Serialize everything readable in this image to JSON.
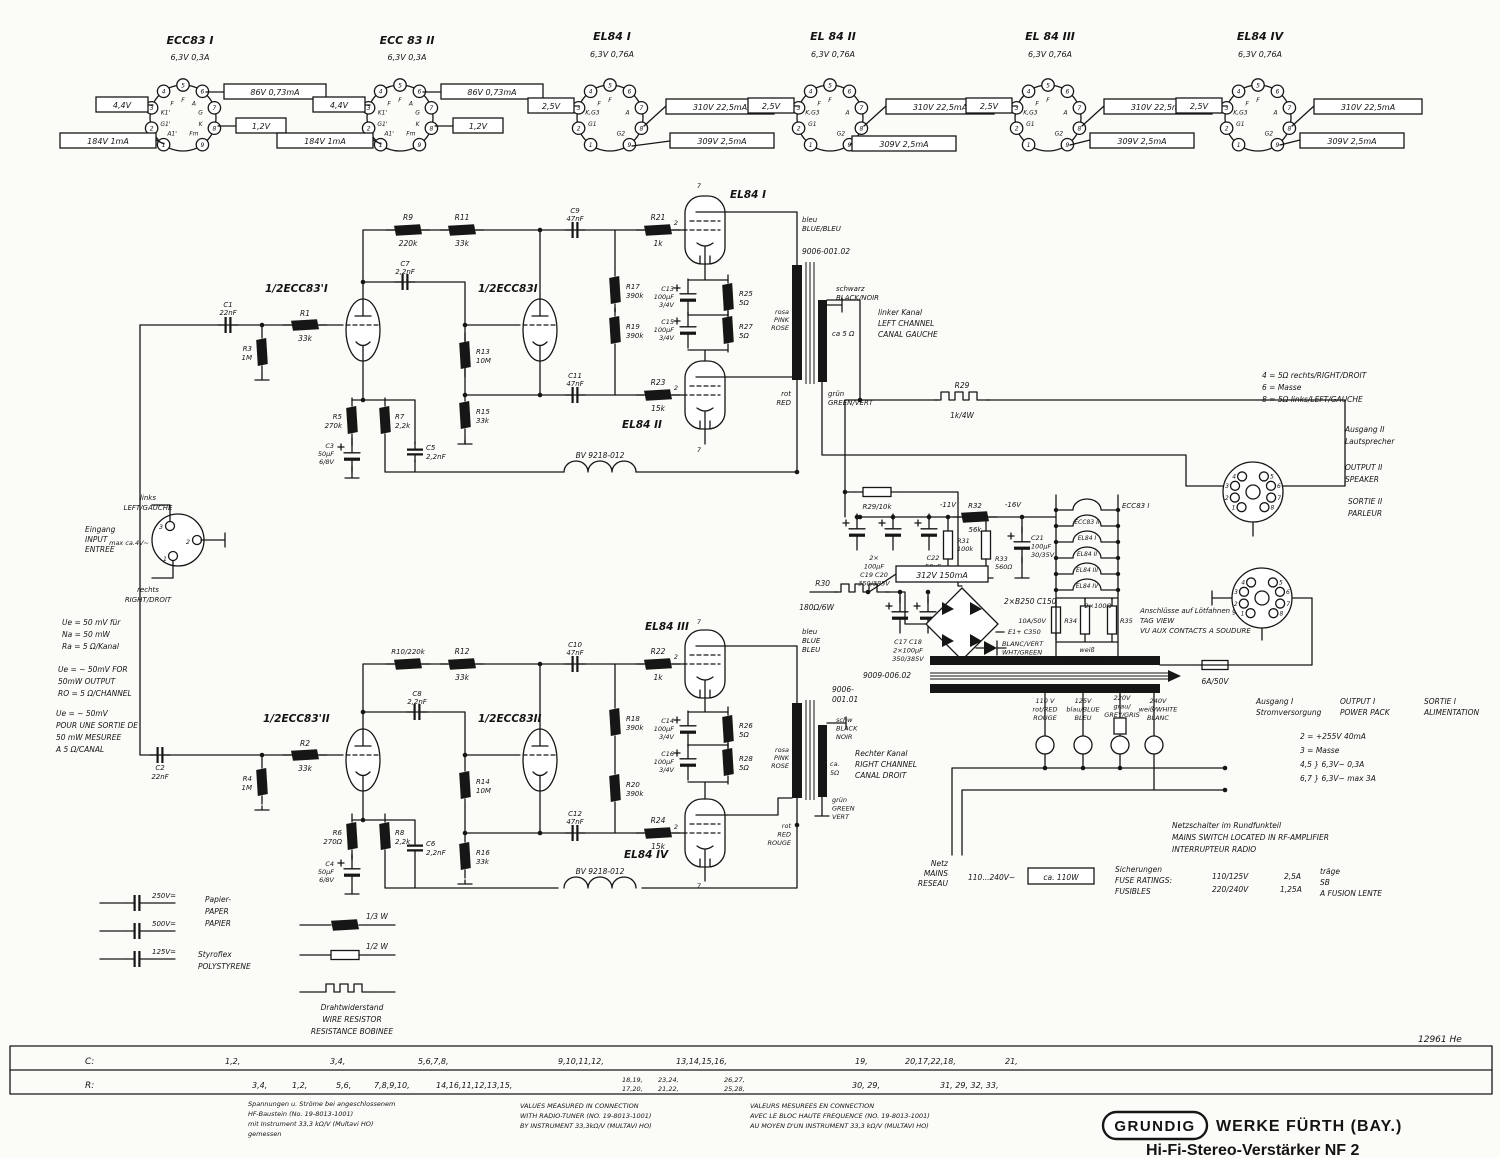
{
  "doc": {
    "number": "12961 He"
  },
  "logo": {
    "brand": "GRUNDIG",
    "firm": "WERKE FÜRTH (BAY.)",
    "model": "Hi-Fi-Stereo-Verstärker NF 2"
  },
  "digits": [
    "0",
    "1",
    "2",
    "3",
    "4",
    "5",
    "6",
    "7",
    "8",
    "9"
  ],
  "tube_sockets": [
    {
      "title": "ECC83 I",
      "heater": "6,3V 0,3A",
      "left": "4,4V",
      "bottom": "184V 1mA",
      "right_top": "86V 0,73mA",
      "right_bottom": "1,2V",
      "pins": {
        "1": "A1'",
        "2": "G1'",
        "3": "K1'",
        "4": "F",
        "5": "F",
        "6": "A",
        "7": "G",
        "8": "K",
        "9": "Fm"
      }
    },
    {
      "title": "ECC 83 II",
      "heater": "6,3V 0,3A",
      "left": "4,4V",
      "bottom": "184V 1mA",
      "right_top": "86V 0,73mA",
      "right_bottom": "1,2V",
      "pins": {
        "1": "A1'",
        "2": "G1'",
        "3": "K1'",
        "4": "F",
        "5": "F",
        "6": "A",
        "7": "G",
        "8": "K",
        "9": "Fm"
      }
    },
    {
      "title": "EL84 I",
      "heater": "6,3V 0,76A",
      "left": "2,5V",
      "right_top": "310V 22,5mA",
      "right_bottom": "309V 2,5mA",
      "pins": {
        "2": "G1",
        "3": "K,G3",
        "4": "F",
        "5": "F",
        "7": "A",
        "9": "G2"
      }
    },
    {
      "title": "EL 84 II",
      "heater": "6,3V 0,76A",
      "left": "2,5V",
      "right_top": "310V 22,5mA",
      "right_bottom": "309V 2,5mA",
      "pins": {
        "2": "G1",
        "3": "K,G3",
        "4": "F",
        "5": "F",
        "7": "A",
        "9": "G2"
      }
    },
    {
      "title": "EL 84 III",
      "heater": "6,3V 0,76A",
      "left": "2,5V",
      "right_top": "310V 22,5mA",
      "right_bottom": "309V 2,5mA",
      "pins": {
        "2": "G1",
        "3": "K,G3",
        "4": "F",
        "5": "F",
        "7": "A",
        "9": "G2"
      }
    },
    {
      "title": "EL84 IV",
      "heater": "6,3V 0,76A",
      "left": "2,5V",
      "right_top": "310V 22,5mA",
      "right_bottom": "309V 2,5mA",
      "pins": {
        "2": "G1",
        "3": "K,G3",
        "4": "F",
        "5": "F",
        "7": "A",
        "9": "G2"
      }
    }
  ],
  "upper": {
    "t1": "1/2ECC83'I",
    "t2": "1/2ECC83I",
    "el1": "EL84 I",
    "el2": "EL84 II",
    "c1": [
      "C1",
      "22nF"
    ],
    "r1": [
      "R1",
      "33k"
    ],
    "r3": [
      "R3",
      "1M"
    ],
    "r5": [
      "R5",
      "270k"
    ],
    "c3": [
      "C3",
      "50µF",
      "6/8V"
    ],
    "r7": [
      "R7",
      "2,2k"
    ],
    "c5": [
      "C5",
      "2,2nF"
    ],
    "c7": [
      "C7",
      "2,2nF"
    ],
    "r9": [
      "R9",
      "220k"
    ],
    "r11": [
      "R11",
      "33k"
    ],
    "r13": [
      "R13",
      "10M"
    ],
    "r15": [
      "R15",
      "33k"
    ],
    "c9": [
      "C9",
      "47nF"
    ],
    "c11": [
      "C11",
      "47nF"
    ],
    "r17": [
      "R17",
      "390k"
    ],
    "r19": [
      "R19",
      "390k"
    ],
    "r21": [
      "R21",
      "1k"
    ],
    "r23": [
      "R23",
      "15k"
    ],
    "c13": [
      "C13",
      "100µF",
      "3/4V"
    ],
    "c15": [
      "C15",
      "100µF",
      "3/4V"
    ],
    "r25": [
      "R25",
      "5Ω"
    ],
    "r27": [
      "R27",
      "5Ω"
    ],
    "bv": "BV 9218-012",
    "r29": [
      "R29",
      "1k/4W"
    ],
    "tr": {
      "part": "9006-001.02",
      "blue": [
        "bleu",
        "BLUE/BLEU"
      ],
      "black": [
        "schwarz",
        "BLACK/NOIR"
      ],
      "pink": [
        "rosa",
        "PINK",
        "ROSE"
      ],
      "red": [
        "rot",
        "RED"
      ],
      "green": [
        "grün",
        "GREEN/VERT"
      ],
      "imp": "ca 5 Ω",
      "channel": [
        "linker Kanal",
        "LEFT CHANNEL",
        "CANAL GAUCHE"
      ]
    }
  },
  "lower": {
    "t3": "1/2ECC83'II",
    "t4": "1/2ECC83II",
    "el3": "EL84 III",
    "el4": "EL84 IV",
    "c2": [
      "C2",
      "22nF"
    ],
    "r2": [
      "R2",
      "33k"
    ],
    "r4": [
      "R4",
      "1M"
    ],
    "r6": [
      "R6",
      "270Ω"
    ],
    "c4": [
      "C4",
      "50µF",
      "6/8V"
    ],
    "r8": [
      "R8",
      "2,2k"
    ],
    "c6": [
      "C6",
      "2,2nF"
    ],
    "c8": [
      "C8",
      "2,2nF"
    ],
    "r10": "R10/220k",
    "r12": [
      "R12",
      "33k"
    ],
    "r14": [
      "R14",
      "10M"
    ],
    "r16": [
      "R16",
      "33k"
    ],
    "c10": [
      "C10",
      "47nF"
    ],
    "c12": [
      "C12",
      "47nF"
    ],
    "r18": [
      "R18",
      "390k"
    ],
    "r20": [
      "R20",
      "390k"
    ],
    "r22": [
      "R22",
      "1k"
    ],
    "r24": [
      "R24",
      "15k"
    ],
    "c14": [
      "C14",
      "100µF",
      "3/4V"
    ],
    "c16": [
      "C16",
      "100µF",
      "3/4V"
    ],
    "r26": [
      "R26",
      "5Ω"
    ],
    "r28": [
      "R28",
      "5Ω"
    ],
    "bv": "BV 9218-012",
    "tr": {
      "part": [
        "9006-",
        "001.01"
      ],
      "blue": [
        "bleu",
        "BLUE",
        "BLEU"
      ],
      "black": [
        "schw",
        "BLACK",
        "NOIR"
      ],
      "pink": [
        "rosa",
        "PINK",
        "ROSE"
      ],
      "green": [
        "grün",
        "GREEN",
        "VERT"
      ],
      "red": [
        "rot",
        "RED",
        "ROUGE"
      ],
      "imp": [
        "ca.",
        "5Ω"
      ],
      "channel": [
        "Rechter Kanal",
        "RIGHT CHANNEL",
        "CANAL DROIT"
      ]
    }
  },
  "psu": {
    "r29b": "R29/10k",
    "c19_20": [
      "2×",
      "100µF",
      "C19 C20",
      "350/385V"
    ],
    "c22": [
      "C22",
      "50µF",
      "15/16V"
    ],
    "v11": "-11V",
    "v16": "-16V",
    "r32": [
      "R32",
      "56k"
    ],
    "r31": [
      "R31",
      "100k"
    ],
    "r33": [
      "R33",
      "560Ω"
    ],
    "c21": [
      "C21",
      "100µF",
      "30/35V"
    ],
    "hv": "312V 150mA",
    "r30": [
      "R30",
      "180Ω/6W"
    ],
    "c17_18": [
      "C17 C18",
      "2×100µF",
      "350/385V"
    ],
    "rectifier": "2×B250 C150",
    "e1": "E1+ C350",
    "diode": [
      "BLANC/VERT",
      "WHT/GREEN"
    ],
    "mains_tr": "9009-006.02",
    "heater_title": "ECC83 I",
    "heaters": [
      "ECC83 II",
      "EL84 I",
      "EL84 II",
      "EL84 III",
      "EL84 IV"
    ],
    "r34_35": {
      "label": "2×100Ω",
      "a": "R34",
      "b": "R35"
    },
    "heater_fuse": "10A/50V",
    "white": [
      "weiß",
      "WHT/BLANC"
    ],
    "tag_view": [
      "Anschlüsse auf Lötfahnen gesehen",
      "TAG VIEW",
      "VU AUX CONTACTS A SOUDURE"
    ],
    "fuse_out": "6A/50V",
    "taps": [
      [
        "110 V",
        "rot/RED",
        "ROUGE"
      ],
      [
        "125V",
        "blau/BLUE",
        "BLEU"
      ],
      [
        "220V",
        "grau/",
        "GREY/GRIS"
      ],
      [
        "240V",
        "weiß/WHITE",
        "BLANC"
      ]
    ],
    "mains": {
      "label": [
        "Netz",
        "MAINS",
        "RESEAU"
      ],
      "range": "110...240V~",
      "power": "ca. 110W"
    },
    "fuse_table": {
      "head": [
        "Sicherungen",
        "FUSE RATINGS:",
        "FUSIBLES"
      ],
      "rows": [
        "110/125V",
        "220/240V"
      ],
      "amps": [
        "2,5A",
        "1,25A"
      ],
      "slow": [
        "träge",
        "SB",
        "A FUSION LENTE"
      ]
    },
    "switch_note": [
      "Netzschalter im Rundfunkteil",
      "MAINS SWITCH LOCATED IN RF-AMPLIFIER",
      "INTERRUPTEUR RADIO"
    ]
  },
  "outputs": {
    "spk_note": [
      "4 = 5Ω  rechts/RIGHT/DROIT",
      "6 = Masse",
      "8 = 5Ω  links/LEFT/GAUCHE"
    ],
    "out2_de": [
      "Ausgang II",
      "Lautsprecher"
    ],
    "out2_en": [
      "OUTPUT II",
      "SPEAKER"
    ],
    "out2_fr": [
      "SORTIE II",
      "PARLEUR"
    ],
    "out1_de": [
      "Ausgang I",
      "Stromversorgung"
    ],
    "out1_en": [
      "OUTPUT I",
      "POWER PACK"
    ],
    "out1_fr": [
      "SORTIE I",
      "ALIMENTATION"
    ],
    "out1_pins": [
      "2 = +255V   40mA",
      "3 = Masse",
      "4,5 }  6,3V~    0,3A",
      "6,7 }  6,3V~   max 3A"
    ]
  },
  "input": {
    "label": [
      "Eingang",
      "INPUT",
      "ENTREE"
    ],
    "top": [
      "links",
      "LEFT/GAUCHE"
    ],
    "bottom": [
      "rechts",
      "RIGHT/DROIT"
    ],
    "max": "max ca.4V~",
    "spec_de": [
      "Ue = 50 mV für",
      "Na = 50 mW",
      "Ra = 5 Ω/Kanal"
    ],
    "spec_en": [
      "Ue = ~ 50mV FOR",
      "50mW OUTPUT",
      "RO = 5 Ω/CHANNEL"
    ],
    "spec_fr": [
      "Ue = ~ 50mV",
      "POUR UNE SORTIE DE",
      "50 mW MESUREE",
      "A 5 Ω/CANAL"
    ]
  },
  "legend": {
    "cap_values": [
      "250V=",
      "500V=",
      "125V="
    ],
    "paper": [
      "Papier-",
      "PAPER",
      "PAPIER"
    ],
    "styro": [
      "Styroflex",
      "POLYSTYRENE"
    ],
    "w13": "1/3 W",
    "w12": "1/2 W",
    "wire": [
      "Drahtwiderstand",
      "WIRE RESISTOR",
      "RESISTANCE BOBINEE"
    ]
  },
  "table": {
    "c_label": "C:",
    "r_label": "R:",
    "c_cells": [
      "1,2,",
      "3,4,",
      "5,6,7,8,",
      "9,10,11,12,",
      "13,14,15,16,",
      "19,",
      "20,17,22,18,",
      "21,"
    ],
    "r_cells": [
      "3,4,",
      "1,2,",
      "5,6,",
      "7,8,9,10,",
      "14,16,11,12,13,15,",
      "30, 29,",
      "31, 29, 32, 33,"
    ],
    "r_stacked": [
      [
        "18,19,",
        "17,20,"
      ],
      [
        "23,24,",
        "21,22,"
      ],
      [
        "26,27,",
        "25,28,"
      ]
    ]
  },
  "notes": {
    "de": [
      "Spannungen u. Ströme bei angeschlossenem",
      "HF-Baustein (No. 19-8013-1001)",
      "mit Instrument 33,3 kΩ/V (Multavi HO)",
      "gemessen"
    ],
    "en": [
      "VALUES MEASURED IN CONNECTION",
      "WITH RADIO-TUNER (NO. 19-8013-1001)",
      "BY INSTRUMENT 33,3kΩ/V (MULTAVI HO)"
    ],
    "fr": [
      "VALEURS MESUREES EN CONNECTION",
      "AVEC LE BLOC HAUTE FREQUENCE (NO. 19-8013-1001)",
      "AU MOYEN D'UN INSTRUMENT 33,3 kΩ/V (MULTAVI HO)"
    ]
  }
}
